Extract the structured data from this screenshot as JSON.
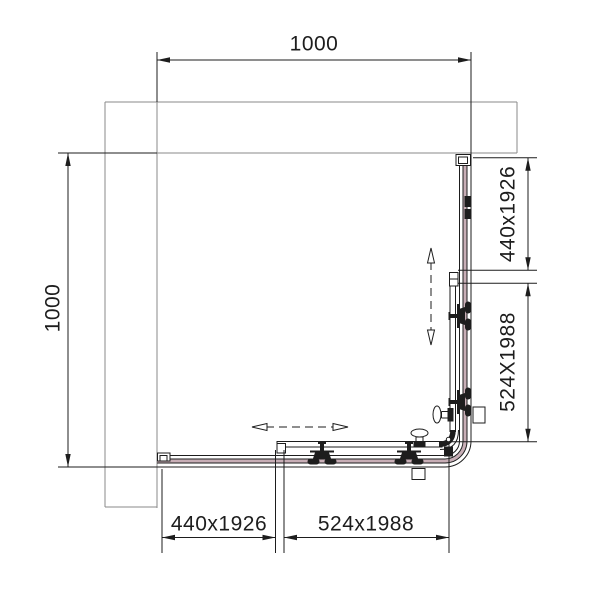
{
  "drawing": {
    "type": "technical-plan",
    "subject": "Corner shower enclosure plan view with two fixed panels and two sliding doors",
    "labels": {
      "top_width": "1000",
      "left_depth": "1000",
      "right_fixed_panel": "440x1926",
      "right_sliding_door": "524X1988",
      "bottom_fixed_panel": "440x1926",
      "bottom_sliding_door": "524x1988"
    },
    "icons": {
      "roller": "door-roller-icon",
      "handle": "door-knob-icon",
      "slide_arrow": "slide-direction-arrow"
    },
    "colors": {
      "line_dark": "#1d1d1d",
      "wall_gray": "#8a8a8a",
      "glass_pink": "#c8aeb6",
      "background": "#ffffff"
    }
  }
}
